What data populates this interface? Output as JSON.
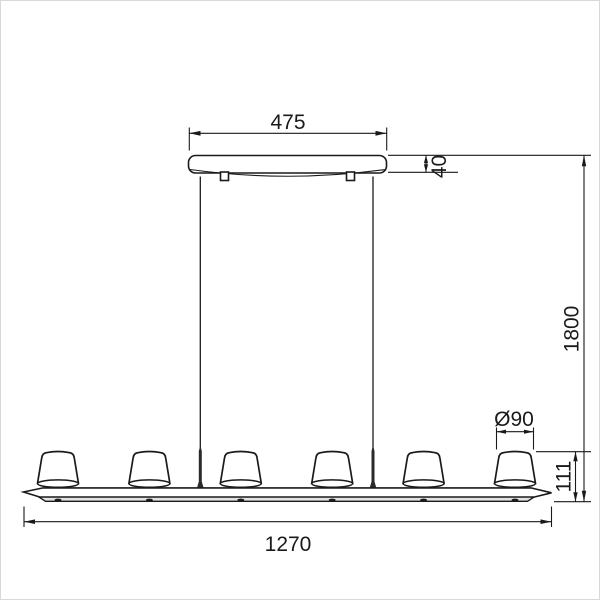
{
  "drawing": {
    "kind": "technical dimension drawing",
    "line_color": "#1a1a1a",
    "background_color": "#ffffff",
    "shade_count": 6,
    "dimensions": {
      "canopy_width": "475",
      "canopy_height": "40",
      "suspension_drop": "1800",
      "shade_diameter": "Ø90",
      "shade_height": "111",
      "fixture_length": "1270"
    }
  }
}
